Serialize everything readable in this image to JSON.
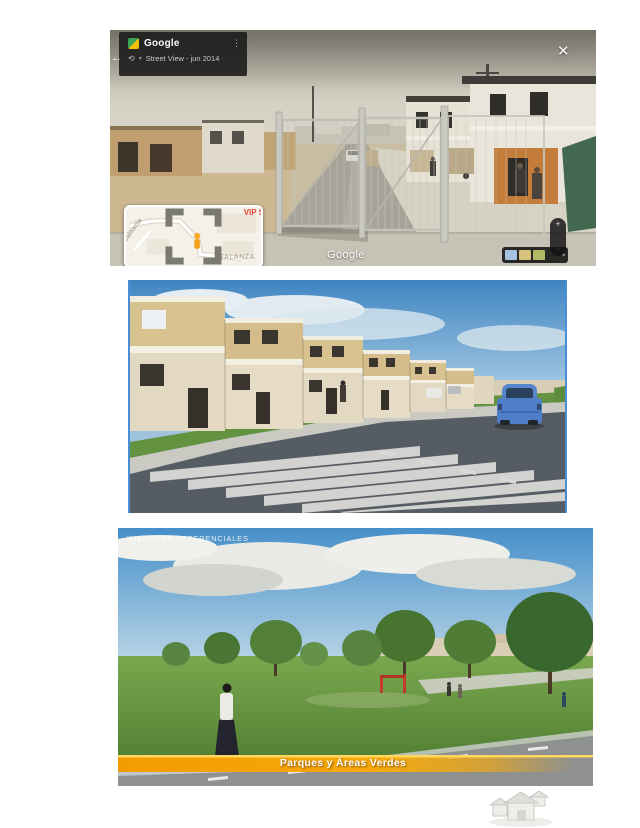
{
  "colors": {
    "selection_blue": "#4a8fd6",
    "banner_orange": "#f6aa0c",
    "banner_highlight": "#ffd65e",
    "panel_dark": "rgba(30,30,30,0.92)",
    "poi_red": "#e8443a",
    "pegman_orange": "#fbab2a",
    "thumb_blue": "#a6c2de",
    "thumb_tan": "#d8c37c",
    "thumb_olive": "#b3b863"
  },
  "street_view": {
    "back_icon": "←",
    "app": {
      "name": "Google",
      "menu_icon": "⋮"
    },
    "mode": {
      "history_icon": "⟲",
      "caret_icon": "▾",
      "label": "Street View - jun 2014"
    },
    "close_icon": "✕",
    "watermark": "Google",
    "minimap": {
      "street_left": "California",
      "street_top": "C",
      "poi": "VIP S",
      "place": "BALANZA"
    },
    "zoom": {
      "in": "+",
      "out": "−"
    },
    "thumbbar_icon": "▪"
  },
  "park": {
    "header": "IMAGENES REFERENCIALES",
    "banner": "Parques y Áreas Verdes"
  }
}
